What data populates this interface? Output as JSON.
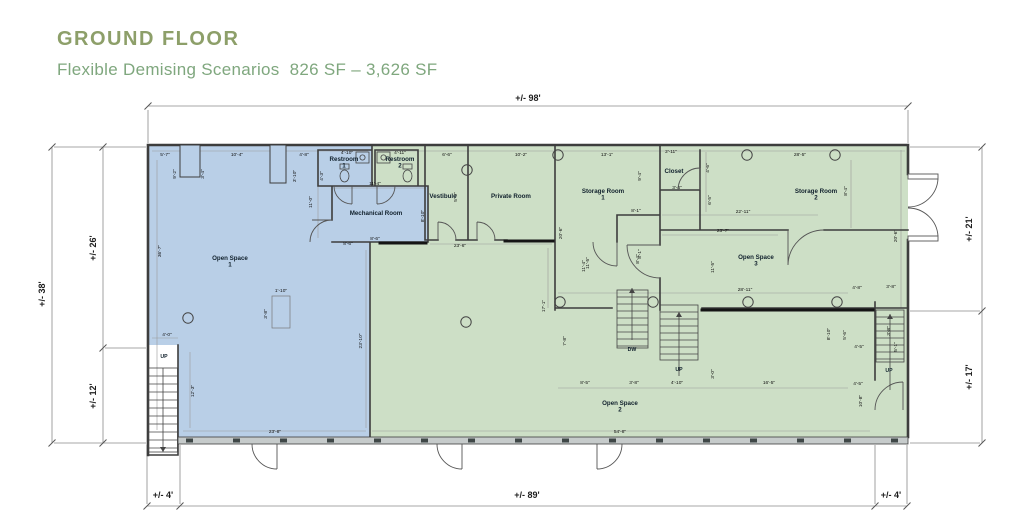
{
  "header": {
    "title": "GROUND FLOOR",
    "subtitle": "Flexible Demising Scenarios  826 SF – 3,626 SF"
  },
  "colors": {
    "title_green": "#8d9f69",
    "subtitle_green": "#7fa77e",
    "unit_blue_fill": "#b9cfe7",
    "unit_green_fill": "#cddfc6",
    "wall_dark": "#3d3d3d"
  },
  "plan": {
    "exterior_dims": [
      {
        "t": "+/- 98'",
        "x": 528,
        "y": 101,
        "r": 0
      },
      {
        "t": "+/- 38'",
        "x": 45,
        "y": 294,
        "r": 1
      },
      {
        "t": "+/- 26'",
        "x": 96,
        "y": 248,
        "r": 1
      },
      {
        "t": "+/- 12'",
        "x": 96,
        "y": 396,
        "r": 1
      },
      {
        "t": "+/- 21'",
        "x": 972,
        "y": 229,
        "r": 1
      },
      {
        "t": "+/- 17'",
        "x": 972,
        "y": 377,
        "r": 1
      },
      {
        "t": "+/- 4'",
        "x": 163,
        "y": 498,
        "r": 0
      },
      {
        "t": "+/- 89'",
        "x": 527,
        "y": 498,
        "r": 0
      },
      {
        "t": "+/- 4'",
        "x": 891,
        "y": 498,
        "r": 0
      }
    ],
    "interior_dims": [
      {
        "t": "5'-7\"",
        "x": 165,
        "y": 156
      },
      {
        "t": "10'-4\"",
        "x": 237,
        "y": 156
      },
      {
        "t": "4'-8\"",
        "x": 304,
        "y": 156
      },
      {
        "t": "4'-10\"",
        "x": 347,
        "y": 154
      },
      {
        "t": "4'-11\"",
        "x": 400,
        "y": 154
      },
      {
        "t": "6'-6\"",
        "x": 447,
        "y": 156
      },
      {
        "t": "10'-2\"",
        "x": 521,
        "y": 156
      },
      {
        "t": "13'-1\"",
        "x": 607,
        "y": 156
      },
      {
        "t": "2'-11\"",
        "x": 671,
        "y": 153
      },
      {
        "t": "28'-5\"",
        "x": 800,
        "y": 156
      },
      {
        "t": "9'-2\"",
        "x": 176,
        "y": 174,
        "r": 1
      },
      {
        "t": "3'-4\"",
        "x": 204,
        "y": 174,
        "r": 1
      },
      {
        "t": "3'-10\"",
        "x": 296,
        "y": 176,
        "r": 1
      },
      {
        "t": "4'-3\"",
        "x": 323,
        "y": 176,
        "r": 1
      },
      {
        "t": "11'-0\"",
        "x": 312,
        "y": 202,
        "r": 1
      },
      {
        "t": "11'-4\"",
        "x": 375,
        "y": 185
      },
      {
        "t": "8'-10\"",
        "x": 424,
        "y": 216,
        "r": 1
      },
      {
        "t": "8'-6\"",
        "x": 375,
        "y": 240
      },
      {
        "t": "5'-0\"",
        "x": 457,
        "y": 197,
        "r": 1
      },
      {
        "t": "23'-6\"",
        "x": 460,
        "y": 247
      },
      {
        "t": "20'-6\"",
        "x": 562,
        "y": 233,
        "r": 1
      },
      {
        "t": "9'-4\"",
        "x": 641,
        "y": 176,
        "r": 1
      },
      {
        "t": "8'-1\"",
        "x": 636,
        "y": 212
      },
      {
        "t": "8'-1\"",
        "x": 641,
        "y": 254,
        "r": 1
      },
      {
        "t": "11'-5\"",
        "x": 589,
        "y": 263,
        "r": 1
      },
      {
        "t": "3'-4\"",
        "x": 677,
        "y": 189
      },
      {
        "t": "4'-6\"",
        "x": 709,
        "y": 168,
        "r": 1
      },
      {
        "t": "6'-5\"",
        "x": 711,
        "y": 200,
        "r": 1
      },
      {
        "t": "22'-11\"",
        "x": 743,
        "y": 213
      },
      {
        "t": "23'-7\"",
        "x": 723,
        "y": 232
      },
      {
        "t": "8'-4\"",
        "x": 847,
        "y": 191,
        "r": 1
      },
      {
        "t": "20'-6\"",
        "x": 897,
        "y": 236,
        "r": 1
      },
      {
        "t": "28'-11\"",
        "x": 745,
        "y": 291
      },
      {
        "t": "11'-5\"",
        "x": 714,
        "y": 267,
        "r": 1
      },
      {
        "t": "8'-4\"",
        "x": 639,
        "y": 259,
        "r": 1
      },
      {
        "t": "11'-4\"",
        "x": 585,
        "y": 266,
        "r": 1
      },
      {
        "t": "17'-1\"",
        "x": 545,
        "y": 306,
        "r": 1
      },
      {
        "t": "7'-8\"",
        "x": 566,
        "y": 341,
        "r": 1
      },
      {
        "t": "36'-7\"",
        "x": 161,
        "y": 251,
        "r": 1
      },
      {
        "t": "1'-10\"",
        "x": 281,
        "y": 292
      },
      {
        "t": "3'-8\"",
        "x": 267,
        "y": 314,
        "r": 1
      },
      {
        "t": "4'-0\"",
        "x": 167,
        "y": 336
      },
      {
        "t": "8'-6\"",
        "x": 348,
        "y": 245
      },
      {
        "t": "23'-10\"",
        "x": 362,
        "y": 341,
        "r": 1
      },
      {
        "t": "12'-3\"",
        "x": 194,
        "y": 391,
        "r": 1
      },
      {
        "t": "23'-8\"",
        "x": 275,
        "y": 433
      },
      {
        "t": "54'-8\"",
        "x": 620,
        "y": 433
      },
      {
        "t": "8'-5\"",
        "x": 585,
        "y": 384
      },
      {
        "t": "3'-8\"",
        "x": 634,
        "y": 384
      },
      {
        "t": "4'-10\"",
        "x": 677,
        "y": 384
      },
      {
        "t": "3'-0\"",
        "x": 714,
        "y": 374,
        "r": 1
      },
      {
        "t": "16'-5\"",
        "x": 769,
        "y": 384
      },
      {
        "t": "4'-8\"",
        "x": 857,
        "y": 289
      },
      {
        "t": "3'-8\"",
        "x": 891,
        "y": 288
      },
      {
        "t": "8'-10\"",
        "x": 830,
        "y": 334,
        "r": 1
      },
      {
        "t": "5'-6\"",
        "x": 846,
        "y": 335,
        "r": 1
      },
      {
        "t": "4'-5\"",
        "x": 859,
        "y": 348
      },
      {
        "t": "3'-8\"",
        "x": 890,
        "y": 331,
        "r": 1
      },
      {
        "t": "5'-1\"",
        "x": 897,
        "y": 347,
        "r": 1
      },
      {
        "t": "4'-5\"",
        "x": 858,
        "y": 385
      },
      {
        "t": "10'-8\"",
        "x": 862,
        "y": 401,
        "r": 1
      }
    ],
    "rooms": [
      {
        "label": "Open Space",
        "num": "1",
        "x": 230,
        "y": 260
      },
      {
        "label": "Open Space",
        "num": "2",
        "x": 620,
        "y": 405
      },
      {
        "label": "Open Space",
        "num": "3",
        "x": 756,
        "y": 259
      },
      {
        "label": "Restroom",
        "num": "1",
        "x": 344,
        "y": 161
      },
      {
        "label": "Restroom",
        "num": "2",
        "x": 400,
        "y": 161
      },
      {
        "label": "Mechanical Room",
        "num": "",
        "x": 376,
        "y": 215
      },
      {
        "label": "Vestibule",
        "num": "",
        "x": 443,
        "y": 198
      },
      {
        "label": "Private Room",
        "num": "",
        "x": 511,
        "y": 198
      },
      {
        "label": "Storage Room",
        "num": "1",
        "x": 603,
        "y": 193
      },
      {
        "label": "Storage Room",
        "num": "2",
        "x": 816,
        "y": 193
      },
      {
        "label": "Closet",
        "num": "",
        "x": 674,
        "y": 173
      }
    ],
    "stair_labels": [
      {
        "label": "UP",
        "x": 164,
        "y": 358
      },
      {
        "label": "DW",
        "x": 632,
        "y": 351
      },
      {
        "label": "UP",
        "x": 679,
        "y": 371
      },
      {
        "label": "UP",
        "x": 889,
        "y": 372
      }
    ]
  }
}
